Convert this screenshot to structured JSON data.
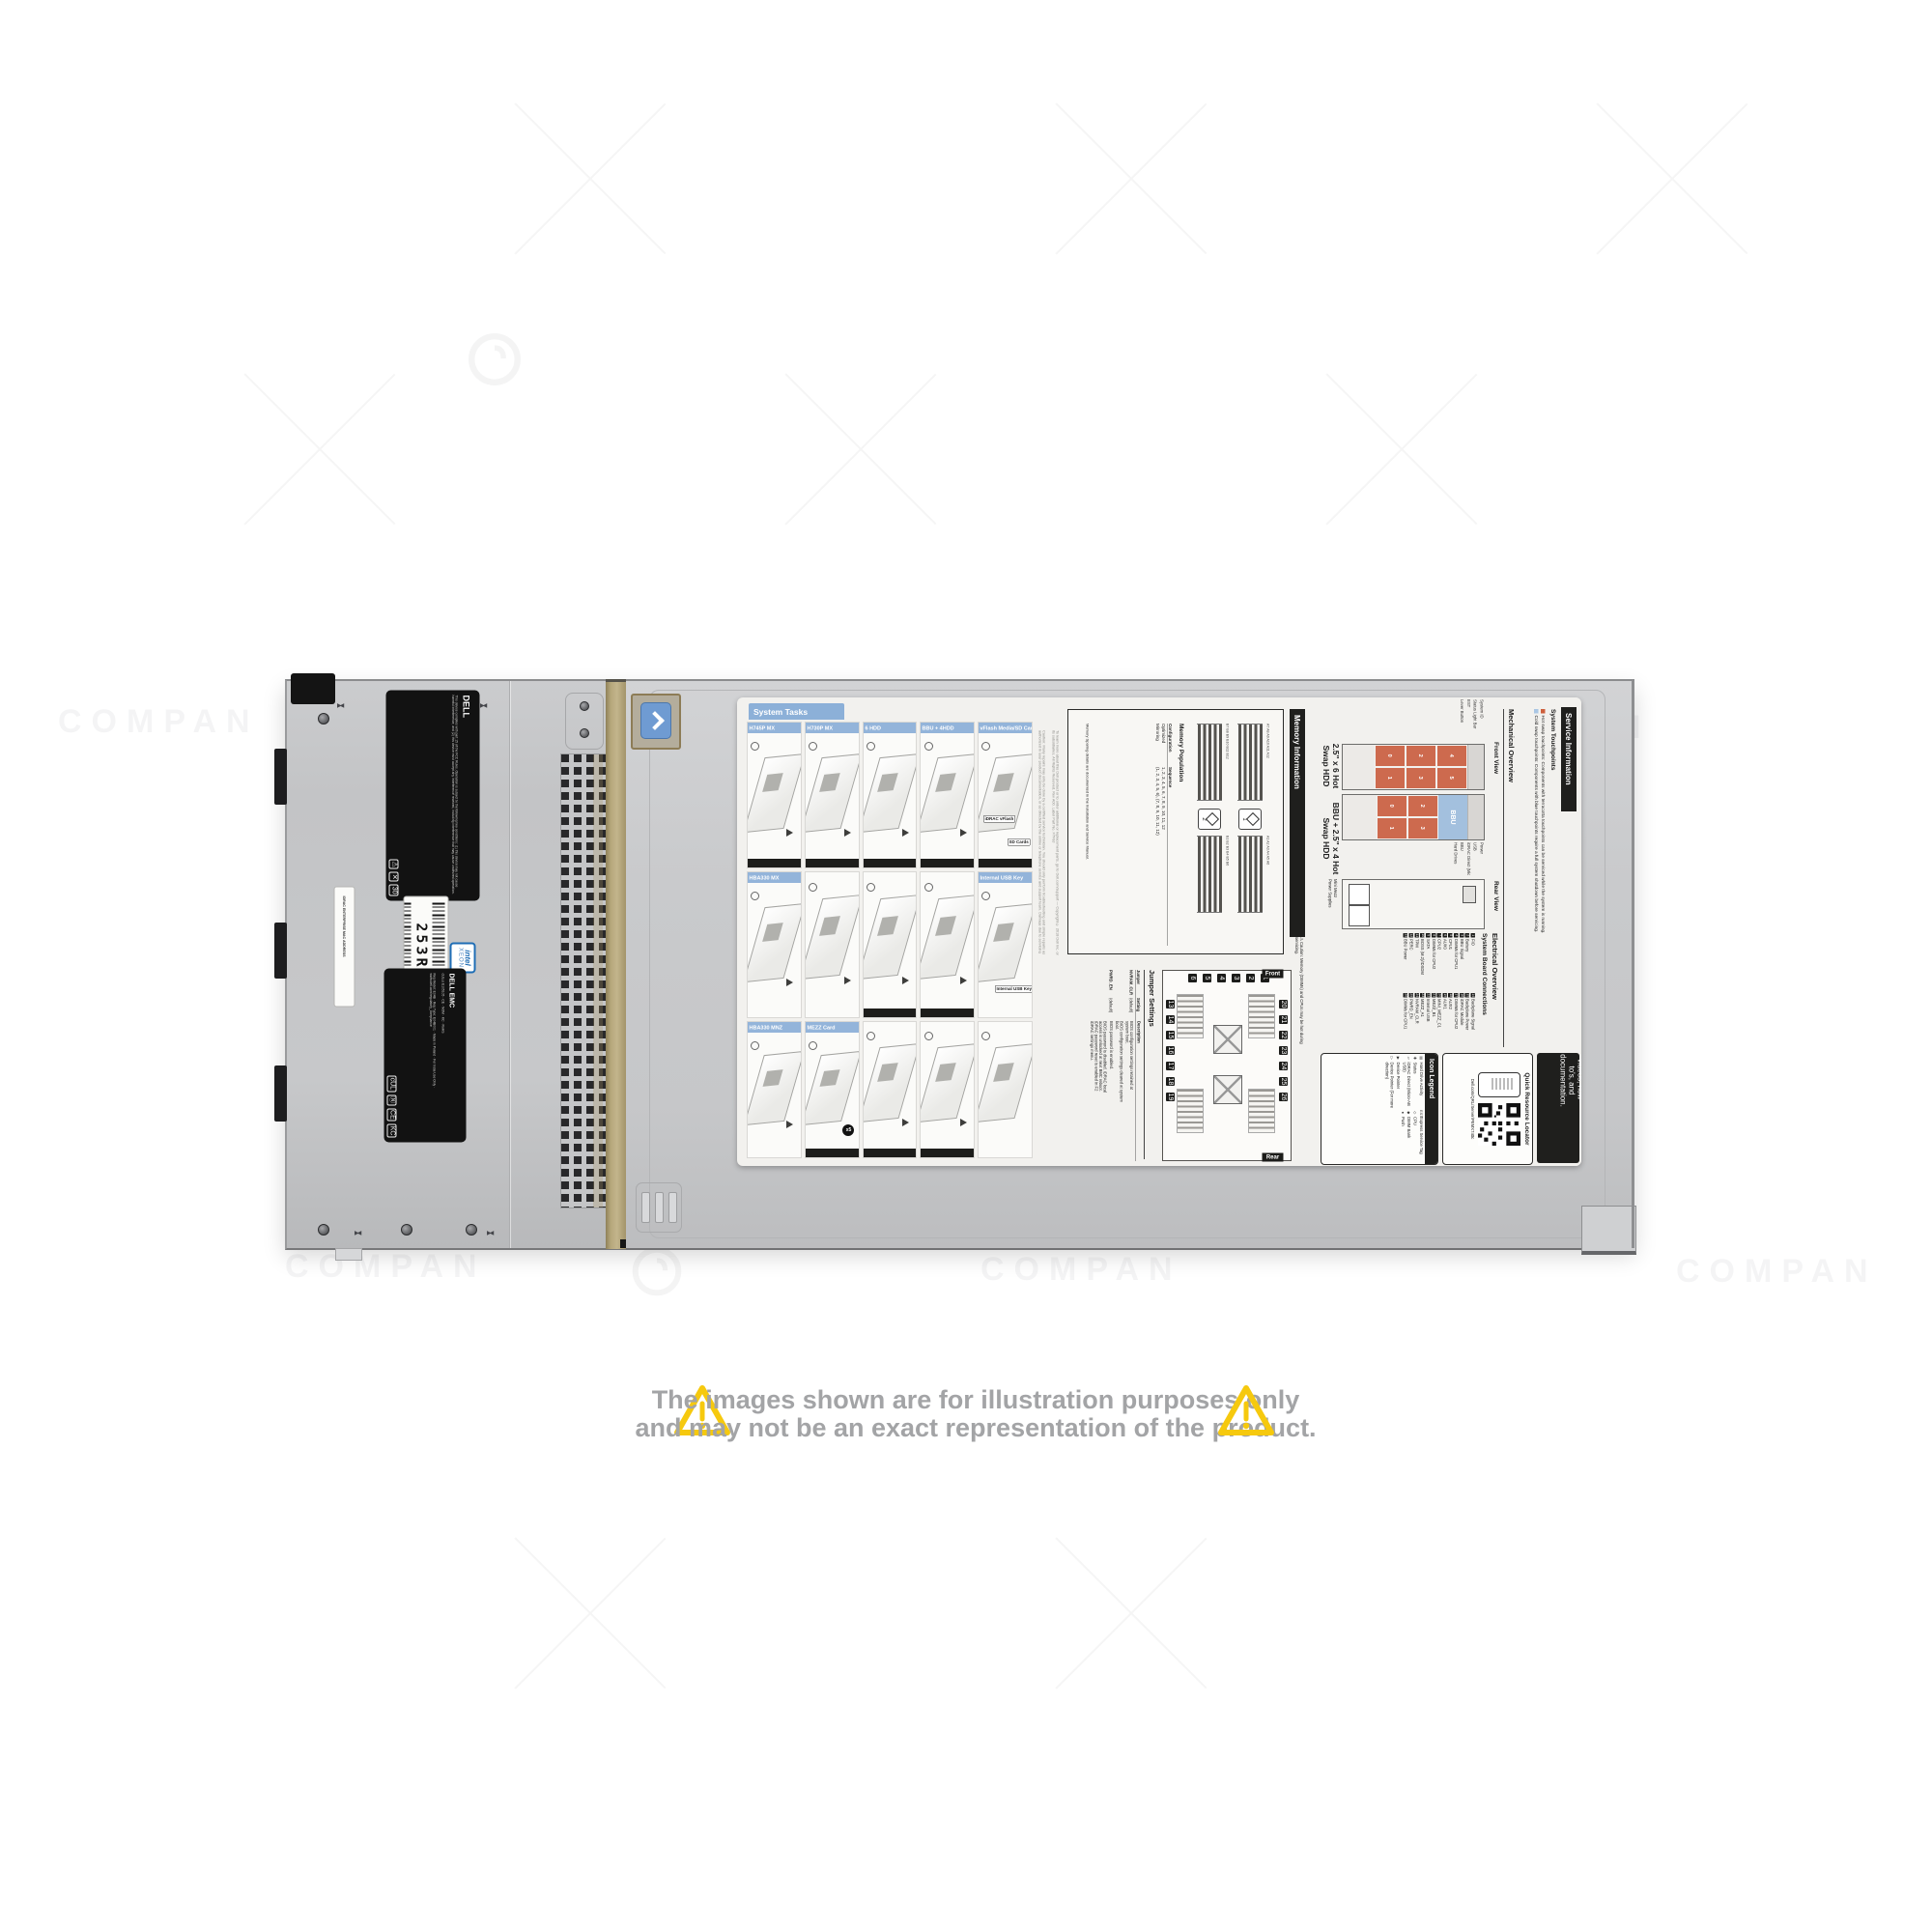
{
  "watermark": {
    "text": "COMPAN"
  },
  "disclaimer": {
    "line1": "The images shown are for illustration purposes only",
    "line2": "and may not be an exact representation of the product.",
    "text_color": "#a3a4a6",
    "triangle_color": "#f6c90e"
  },
  "chassis": {
    "service_tag": "253RQX2",
    "mac_label": "IDRAC ENTERPRISE MAC ADDRESS",
    "intel_badge": {
      "line1": "intel",
      "line2": "XEON"
    },
    "reg_label": {
      "brand": "DELL",
      "text": "This device complies with part 15 of the FCC Rules. Operation is subject to the following two conditions: (1) this device may not cause harmful interference, and (2) this device must accept any interference received, including interference that may cause undesired operation."
    },
    "cert_label": {
      "brand": "DELL EMC",
      "marks": "cULus E105105 · CE · NOM · KC · RoHS",
      "lines": "Reg Model: E04B · Reg Type: E04B001 · Made in Poland · For India Use Only · www.dell.com/regulatory_compliance"
    }
  },
  "label": {
    "service_information": {
      "title": "Service Information"
    },
    "system_touchpoints": {
      "title": "System Touchpoints",
      "hot": "Hot swap touchpoints: Components with terracotta touchpoints can be serviced while the system is running.",
      "cold": "Cold swap touchpoints: Components with blue touchpoints require a full system shutdown before servicing.",
      "hot_color": "#cd5f3c",
      "cold_color": "#a9c6e4"
    },
    "mechanical_overview": {
      "title": "Mechanical Overview",
      "front_view": {
        "title": "Front View",
        "bay1_title": "2.5\" x 6 Hot Swap HDD",
        "bay2_title": "BBU + 2.5\" x 4 Hot Swap HDD",
        "bay1_slots": [
          "4",
          "5",
          "2",
          "3",
          "0",
          "1"
        ],
        "bay2_slots": [
          "2",
          "3",
          "0",
          "1"
        ],
        "bbu": "BBU",
        "callouts_left": [
          "System ID",
          "Status Light Bar",
          "EST",
          "Lever Button"
        ],
        "callouts_right": [
          "Power",
          "USB",
          "iDRAC Direct (Micro-AB USB)",
          "BBU",
          "Hard Drives"
        ]
      },
      "rear_view": {
        "title": "Rear View",
        "label1": "Mini Mezz",
        "label2": "Power Supplies"
      }
    },
    "electrical_overview": {
      "title": "Electrical Overview",
      "subtitle": "System Board Connections",
      "col1": [
        {
          "n": "1",
          "label": "FIO"
        },
        {
          "n": "2",
          "label": "Battery"
        },
        {
          "n": "3",
          "label": "BBU Signal"
        },
        {
          "n": "4",
          "label": "DIMMs for CPU1"
        },
        {
          "n": "5",
          "label": "CPU1"
        },
        {
          "n": "6",
          "label": "AUX0"
        },
        {
          "n": "7",
          "label": "CPU2"
        },
        {
          "n": "8",
          "label": "DIMMs for CPU2"
        },
        {
          "n": "9",
          "label": "SATA"
        },
        {
          "n": "10",
          "label": "BOSS (M.2)/IDSDM"
        },
        {
          "n": "11",
          "label": "TPM"
        },
        {
          "n": "12",
          "label": "PERC"
        },
        {
          "n": "13",
          "label": "BBU Power"
        }
      ],
      "col2": [
        {
          "n": "14",
          "label": "Backplane Signal"
        },
        {
          "n": "15",
          "label": "Backplane Power"
        },
        {
          "n": "16",
          "label": "iDRAC Module"
        },
        {
          "n": "17",
          "label": "DIMMs for CPU2"
        },
        {
          "n": "18",
          "label": "AUX2"
        },
        {
          "n": "19",
          "label": "AUX1"
        },
        {
          "n": "20",
          "label": "MINI_MEZZ_C1"
        },
        {
          "n": "21",
          "label": "MEZZ_B1"
        },
        {
          "n": "22",
          "label": "Internal USB"
        },
        {
          "n": "23",
          "label": "MEZZ_A1"
        },
        {
          "n": "24",
          "label": "NVRAM_CLR"
        },
        {
          "n": "25",
          "label": "PWRD_EN"
        },
        {
          "n": "26",
          "label": "DIMMs for CPU1"
        }
      ]
    },
    "qrl": {
      "scan_text": "Scan to see hardware servicing and software setup videos, how-to's, and documentation.",
      "title": "Quick Resource Locator",
      "url": "Dell.com/QRL/Server/PEMX740c"
    },
    "icon_legend": {
      "title": "Icon Legend",
      "col1": [
        {
          "glyph": "▤",
          "label": "Hard Drive Activity"
        },
        {
          "glyph": "✚",
          "label": "Status"
        },
        {
          "glyph": "▱",
          "label": "iDRAC Direct (Micro-AB USB)"
        },
        {
          "glyph": "▶",
          "label": "Device Pointer"
        },
        {
          "glyph": "▷",
          "label": "Device Pointer (For more direction)"
        }
      ],
      "col2": [
        {
          "glyph": "EST",
          "label": "Express Service Tag"
        },
        {
          "glyph": "◇",
          "label": "CPU"
        },
        {
          "glyph": "◆",
          "label": "DIMM Bank"
        },
        {
          "glyph": "●",
          "label": "Push"
        }
      ]
    },
    "memory_information": {
      "title": "Memory Information",
      "caution": "Caution: Memory (DIMMs) and CPUs may be hot during servicing.",
      "population": {
        "title": "Memory Population",
        "col_config": "Configuration",
        "col_seq": "Sequence",
        "row1_config": "Optimized",
        "row1_seq": "1, 2, 3, 4, 5, 6, 7, 8, 9, 10, 11, 12",
        "row2_config": "Mirroring",
        "row2_seq": "(1, 2, 3, 4, 5, 6), (7, 8, 9, 10, 11, 12)",
        "note": "Memory Sparing details are documented in the Installation and Service Manual.",
        "bank1": "A7 A8 A9 A10 A11 A12",
        "bank2": "A1 A2 A3 A4 A5 A6",
        "bank3": "B7 B8 B9 B10 B11 B12",
        "bank4": "B1 B2 B3 B4 B5 B6",
        "cpu1": "1",
        "cpu2": "2"
      }
    },
    "jumper_settings": {
      "title": "Jumper Settings",
      "col_jumper": "Jumper",
      "col_setting": "Setting",
      "col_desc": "Description",
      "rows": [
        {
          "jumper": "NVRAM_CLR",
          "setting": "(default)",
          "desc": "BIOS configuration settings retained at system boot."
        },
        {
          "jumper": "",
          "setting": "",
          "desc": "BIOS configuration settings cleared at system boot."
        },
        {
          "jumper": "PWRD_EN",
          "setting": "(default)",
          "desc": "BIOS password is enabled."
        },
        {
          "jumper": "",
          "setting": "",
          "desc": "BIOS password is disabled. iDRAC local access is unlocked at next BMC reboot. iDRAC password reset is enabled in F2 iDRAC settings menu."
        }
      ],
      "board_map": {
        "front": "Front",
        "rear": "Rear",
        "top_chips": [
          "20",
          "21",
          "22",
          "23",
          "24",
          "25",
          "26"
        ],
        "bottom_chips": [
          "13",
          "14",
          "15",
          "16",
          "17",
          "18",
          "19"
        ],
        "left_chips": [
          "1",
          "2",
          "3",
          "4",
          "5",
          "6"
        ]
      }
    },
    "system_tasks": {
      "title": "System Tasks",
      "panels": {
        "h745p": "H745P MX",
        "h730p": "H730P MX",
        "hdd6": "6 HDD",
        "bbu4hdd": "BBU + 4HDD",
        "vflash": "vFlash Media/SD Card",
        "hba330mx": "HBA330 MX",
        "internal_usb": "Internal USB Key",
        "hba330mnz": "HBA330 MNZ",
        "mezz": "MEZZ Card"
      },
      "tags": {
        "idrac_vflash": "iDRAC vFlash",
        "sd_cards": "SD Cards",
        "usb_key": "Internal USB Key",
        "x5": "x5"
      },
      "caution": "Caution: Many repairs may only be done by a certified service technician. You should only perform troubleshooting and simple repairs as authorized in your product documentation, or as directed by the online or telephone service and support team. Damage due to servicing that is not authorized by Dell is not covered by your warranty. Read and follow the safety instructions that came with this product.",
      "learn_more": "To learn more about this Dell product or to order additional or replacement parts, go to Dell.com/support",
      "copyright": "Copyright © 2018 Dell Inc. or its subsidiaries. All Rights Reserved. Rev A00. Label Part No. F7F8J"
    }
  }
}
